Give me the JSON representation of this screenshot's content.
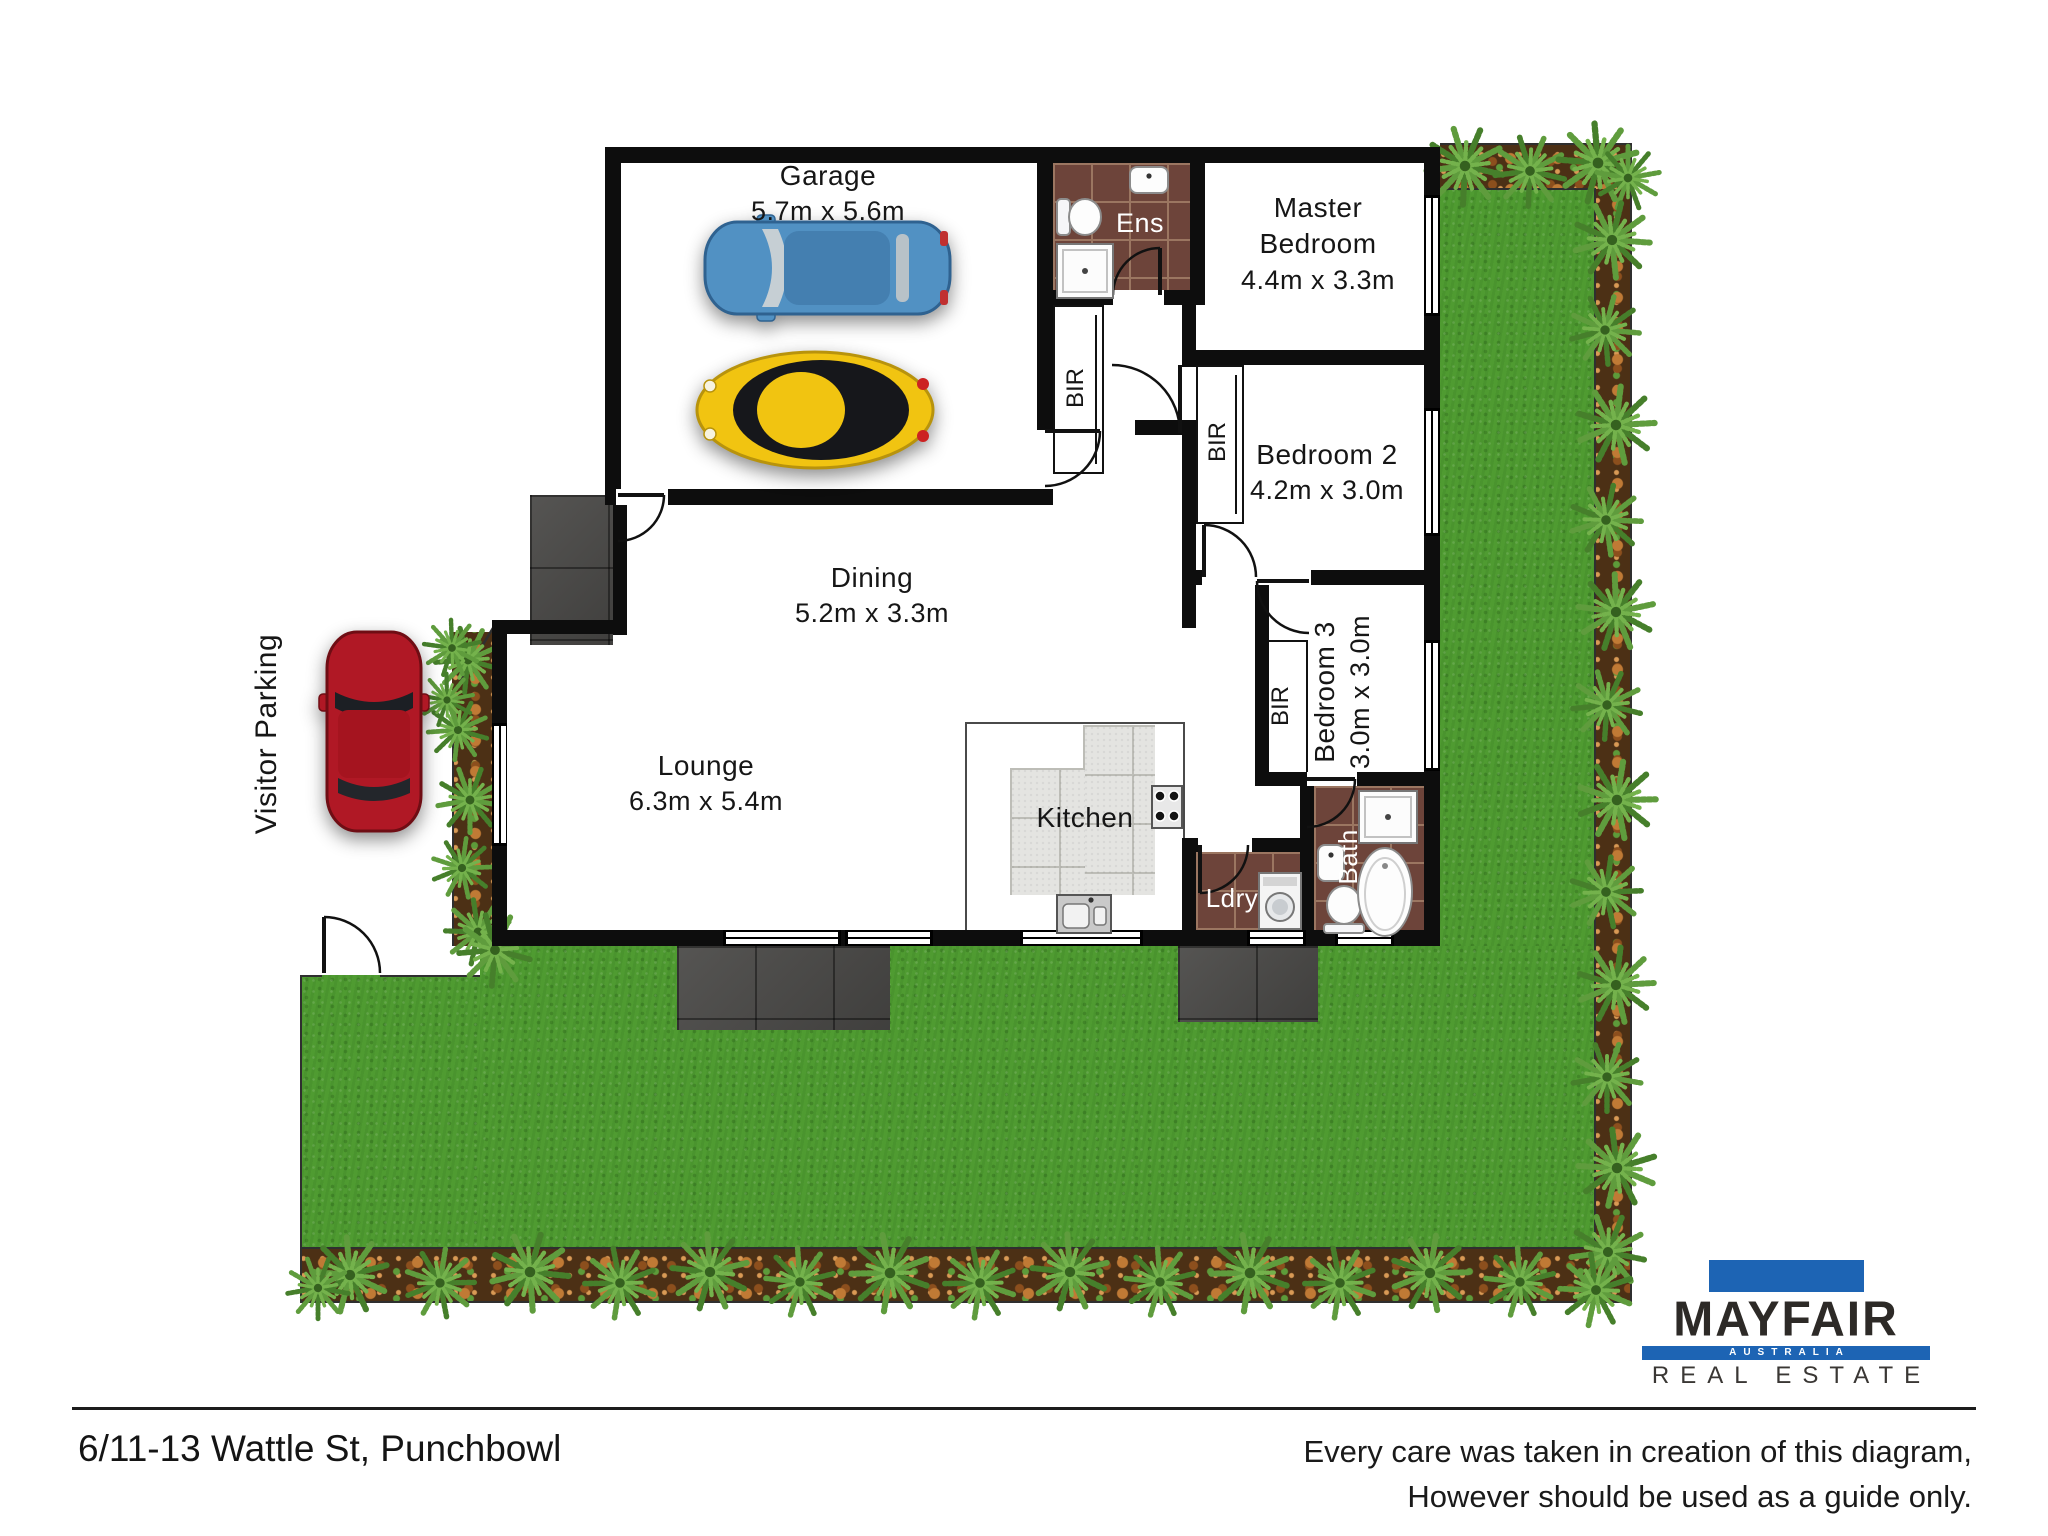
{
  "plan": {
    "rooms": {
      "garage": {
        "name": "Garage",
        "dims": "5.7m x 5.6m"
      },
      "dining": {
        "name": "Dining",
        "dims": "5.2m x 3.3m"
      },
      "lounge": {
        "name": "Lounge",
        "dims": "6.3m x 5.4m"
      },
      "master": {
        "line1": "Master",
        "line2": "Bedroom",
        "dims": "4.4m x 3.3m"
      },
      "bedroom2": {
        "name": "Bedroom 2",
        "dims": "4.2m x 3.0m"
      },
      "bedroom3": {
        "name": "Bedroom 3",
        "dims": "3.0m x 3.0m"
      },
      "kitchen": {
        "name": "Kitchen"
      },
      "ensuite": {
        "name": "Ens"
      },
      "laundry": {
        "name": "Ldry"
      },
      "bath": {
        "name": "Bath"
      }
    },
    "wardrobe_label": "BIR",
    "visitor_parking": "Visitor Parking"
  },
  "footer": {
    "address": "6/11-13 Wattle St, Punchbowl",
    "disclaimer_line1": "Every care was taken in creation of this diagram,",
    "disclaimer_line2": "However should be used as a guide only."
  },
  "logo": {
    "brand": "MAYFAIR",
    "country": "AUSTRALIA",
    "tagline": "REAL ESTATE"
  },
  "colors": {
    "wall": "#0d0d0d",
    "grass": "#4f9b31",
    "garden_bed": "#4c3015",
    "bathroom_tile": "#6d443a",
    "kitchen_tile": "#e4e4e1",
    "paving": "#4b4a48",
    "logo_blue": "#1d64b4",
    "car_blue": "#5191c3",
    "car_yellow": "#f1c411",
    "car_red": "#b01825"
  }
}
